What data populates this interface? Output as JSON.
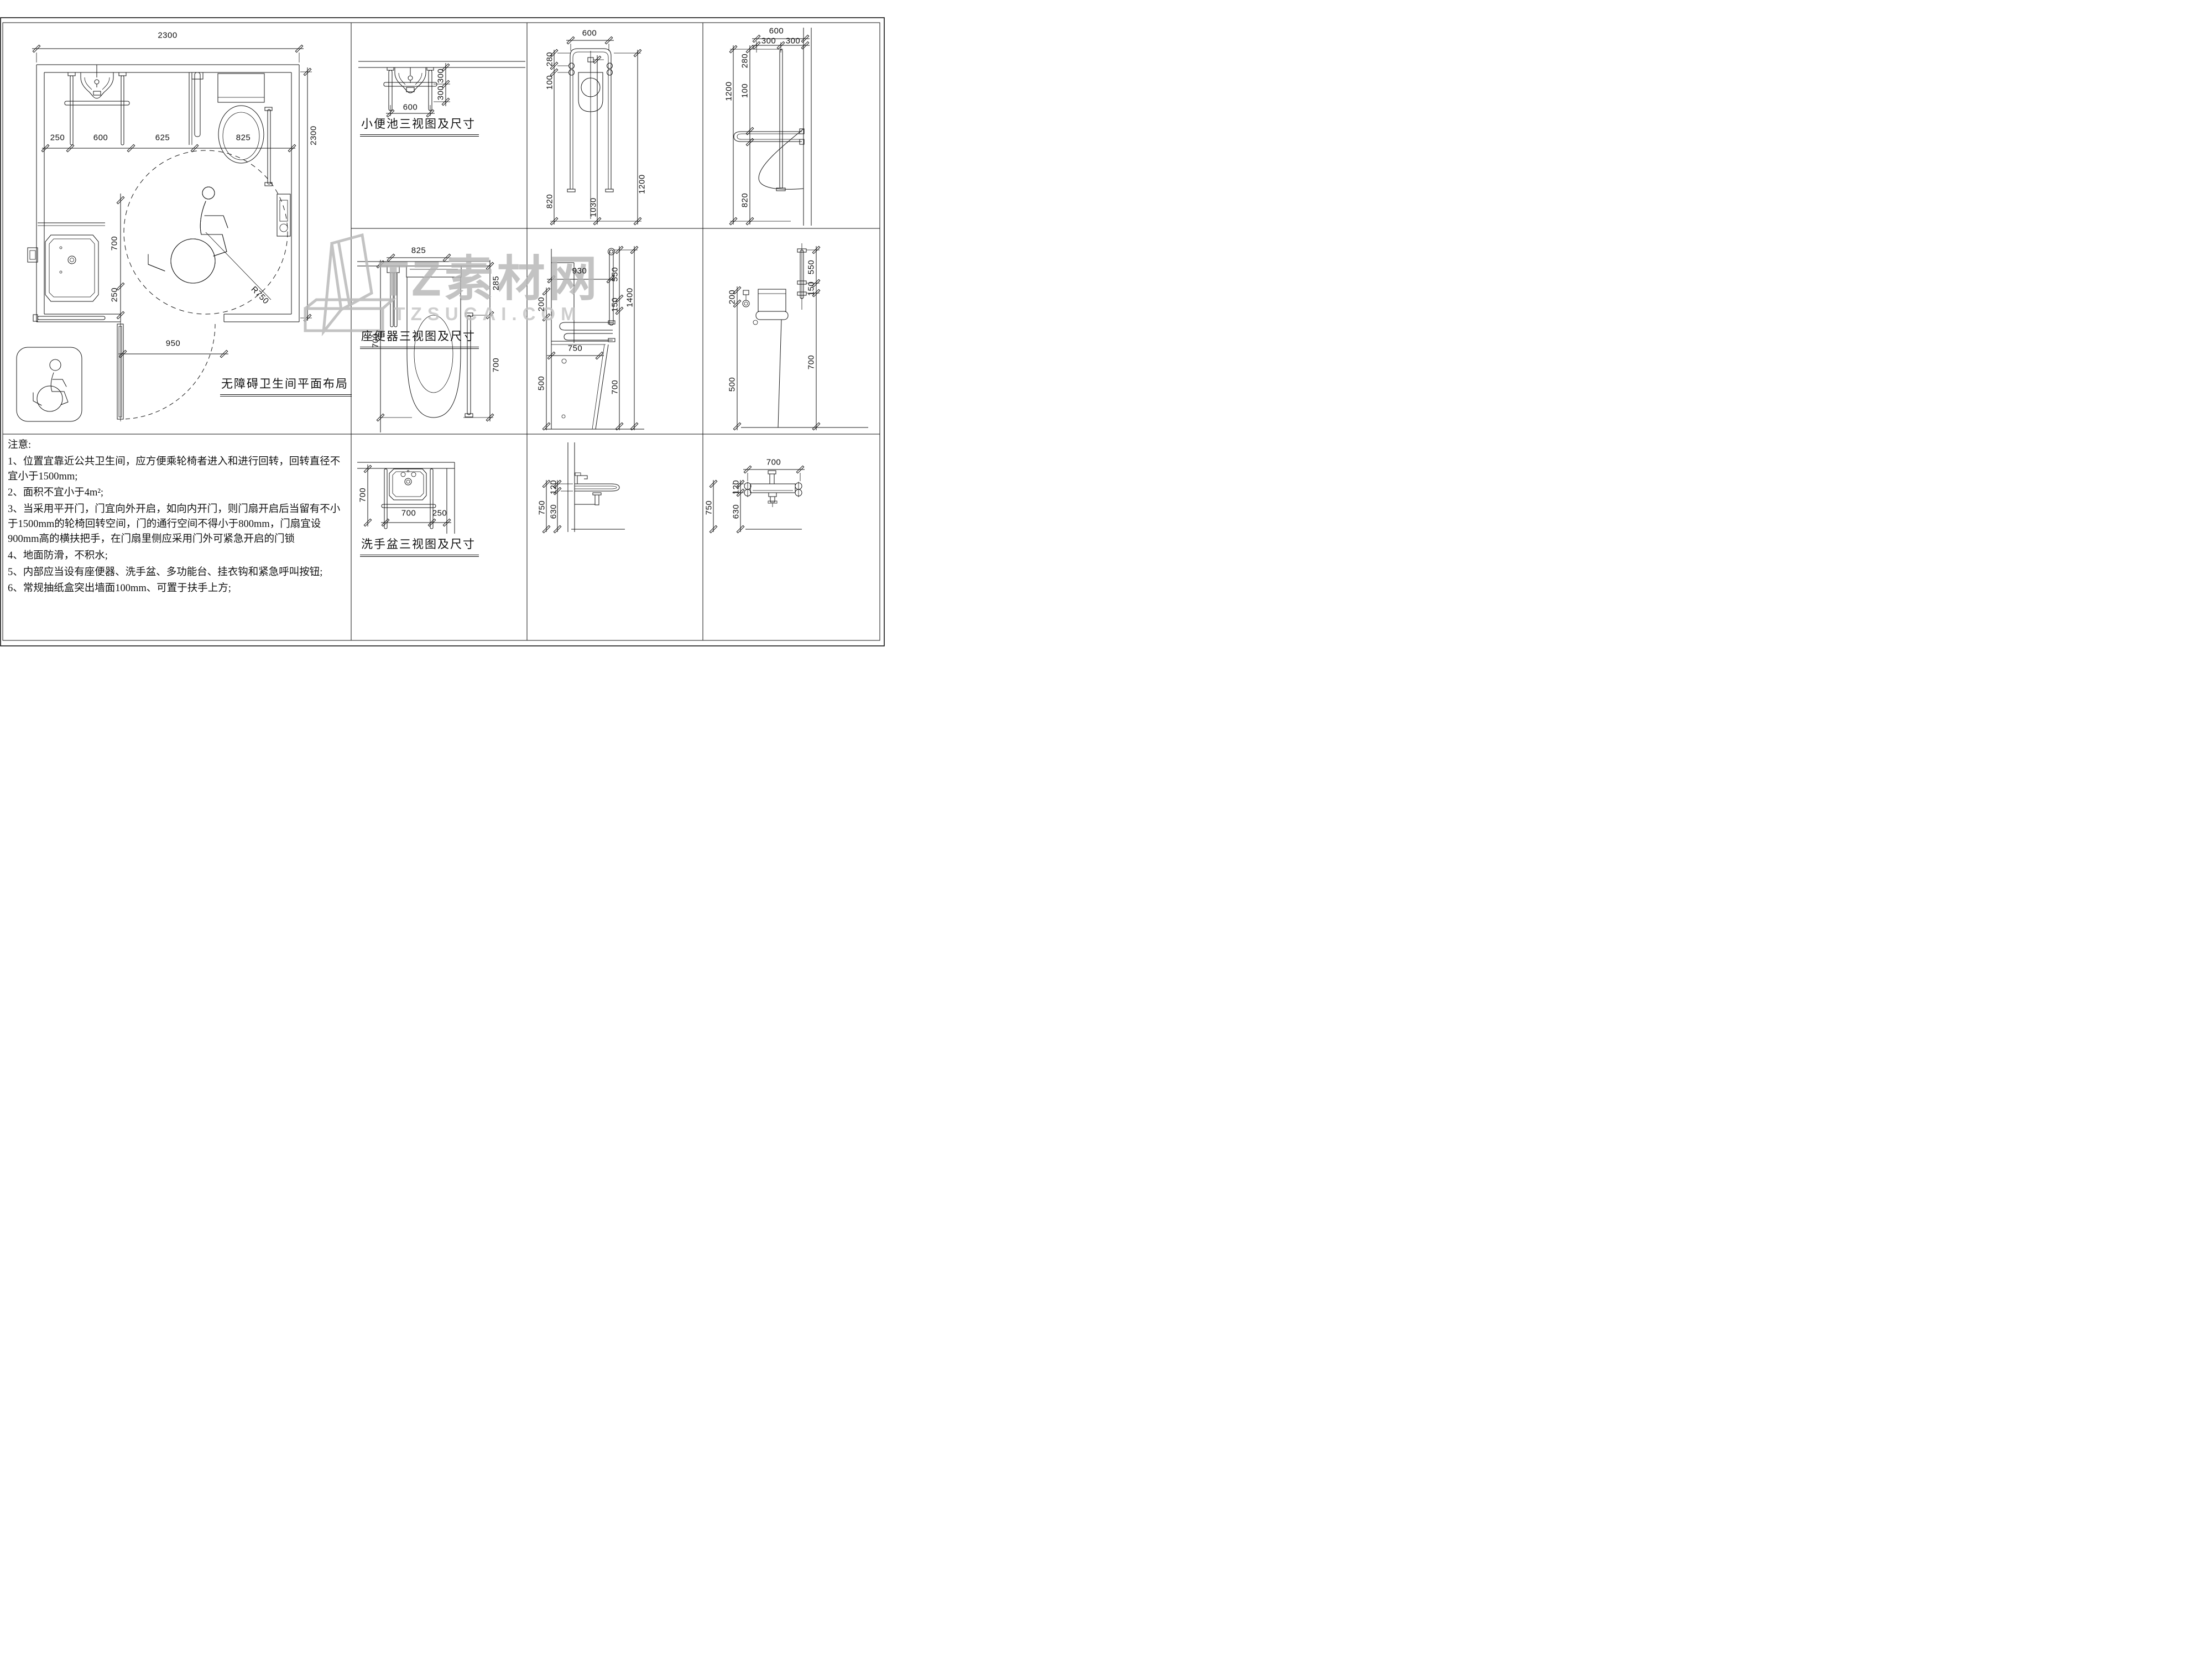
{
  "sheet": {
    "background": "#ffffff",
    "line_color": "#151515",
    "watermark_color": "#b5b5b5"
  },
  "watermark": {
    "brand": "TZ素材网",
    "site": "TZSUCAI.COM"
  },
  "floor_plan": {
    "title": "无障碍卫生间平面布局",
    "dims": {
      "top_width": "2300",
      "seg1": "250",
      "seg2": "600",
      "seg3": "625",
      "seg4": "825",
      "left_depth": "700",
      "left_gap": "250",
      "door_width": "950",
      "right_height": "2300",
      "turn_radius": "R750"
    }
  },
  "urinal": {
    "title": "小便池三视图及尺寸",
    "plan": {
      "upper": "300",
      "lower": "300",
      "width": "600"
    },
    "front": {
      "width": "600",
      "h1": "280",
      "h2": "100",
      "h3": "820",
      "sensor_height": "1030",
      "total_height": "1200"
    },
    "side": {
      "width": "600",
      "half1": "300",
      "half2": "300",
      "h1": "280",
      "h2": "100",
      "h3": "820",
      "total_height": "1200"
    }
  },
  "toilet": {
    "title": "座便器三视图及尺寸",
    "plan": {
      "width": "825",
      "left_depth": "700",
      "rear_gap": "285",
      "bowl_depth": "700"
    },
    "side": {
      "bar_length": "930",
      "bar_rise": "550",
      "bar_gap": "150",
      "bar_top_height": "1400",
      "tank_offset": "200",
      "tank_height": "500",
      "seat_depth": "750",
      "seat_height": "700"
    },
    "front": {
      "tank_offset": "200",
      "tank_height": "500",
      "bar_rise": "550",
      "bar_gap": "150",
      "seat_height": "700"
    }
  },
  "basin": {
    "title": "洗手盆三视图及尺寸",
    "plan": {
      "depth": "700",
      "width": "700",
      "side_gap": "250"
    },
    "side": {
      "total_height": "750",
      "rim_thickness": "120",
      "clearance": "630"
    },
    "front": {
      "width": "700",
      "total_height": "750",
      "rim_thickness": "120",
      "clearance": "630"
    }
  },
  "notes": {
    "title": "注意:",
    "items": [
      "1、位置宜靠近公共卫生间，应方便乘轮椅者进入和进行回转，回转直径不宜小于1500mm;",
      "2、面积不宜小于4m²;",
      "3、当采用平开门，门宜向外开启，如向内开门，则门扇开启后当留有不小于1500mm的轮椅回转空间，门的通行空间不得小于800mm，门扇宜设900mm高的横扶把手，在门扇里侧应采用门外可紧急开启的门锁",
      "4、地面防滑，不积水;",
      "5、内部应当设有座便器、洗手盆、多功能台、挂衣钩和紧急呼叫按钮;",
      "6、常规抽纸盒突出墙面100mm、可置于扶手上方;"
    ]
  }
}
